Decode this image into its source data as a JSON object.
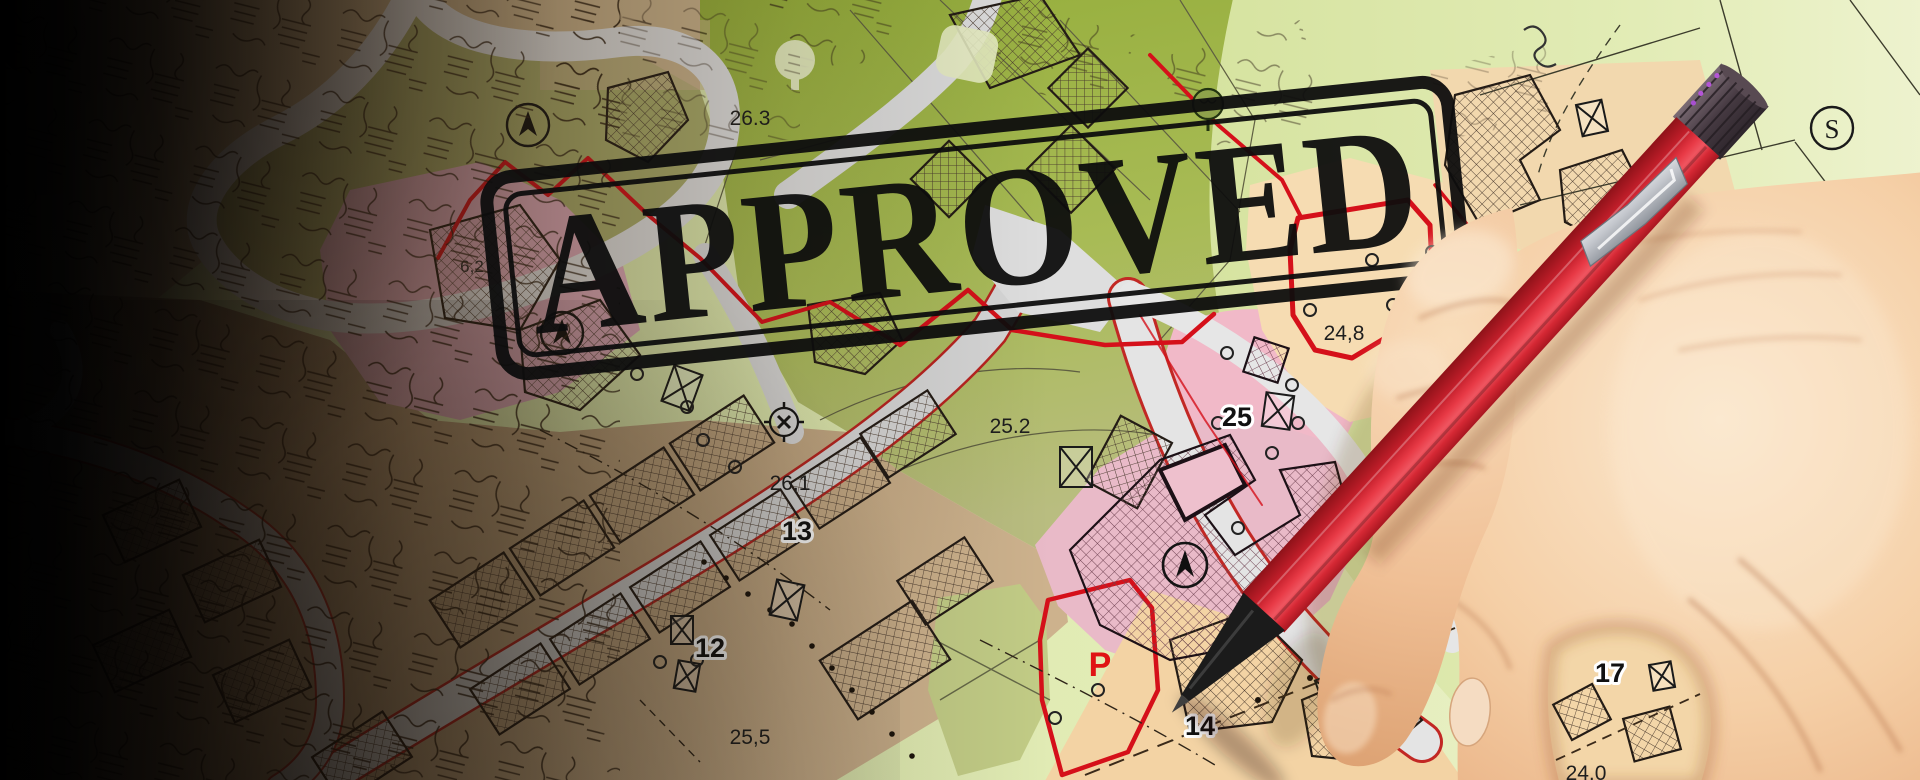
{
  "stamp": {
    "text": "APPROVED",
    "color": "#111111"
  },
  "map": {
    "labels": [
      {
        "id": "elev-26-3",
        "text": "26.3"
      },
      {
        "id": "elev-6-2",
        "text": "6,2"
      },
      {
        "id": "elev-24-8",
        "text": "24,8"
      },
      {
        "id": "parcel-25",
        "text": "25"
      },
      {
        "id": "elev-25-2",
        "text": "25.2"
      },
      {
        "id": "elev-26-1",
        "text": "26,1"
      },
      {
        "id": "parcel-13",
        "text": "13"
      },
      {
        "id": "parcel-12",
        "text": "12"
      },
      {
        "id": "elev-25-5",
        "text": "25,5"
      },
      {
        "id": "parking",
        "text": "P"
      },
      {
        "id": "parcel-14",
        "text": "14"
      },
      {
        "id": "parcel-17",
        "text": "17"
      },
      {
        "id": "elev-24-0",
        "text": "24.0"
      },
      {
        "id": "section-s",
        "text": "S"
      }
    ],
    "symbols": [
      "north-arrow-icon",
      "north-arrow-icon",
      "north-arrow-icon",
      "survey-benchmark-icon",
      "utility-box-icon",
      "tree-icon",
      "circled-s-icon"
    ],
    "colors": {
      "olive_field": "#a9ab6b",
      "bright_field": "#a5b94e",
      "pale_field": "#dfe9ae",
      "urban_tan": "#c6ab89",
      "zone_pink": "#f1b9c8",
      "zone_peach": "#f6dcb2",
      "road_gray": "#dcdcdc",
      "boundary_red": "#d5101a",
      "stamp_black": "#111111",
      "pencil_red": "#d8232f"
    }
  }
}
